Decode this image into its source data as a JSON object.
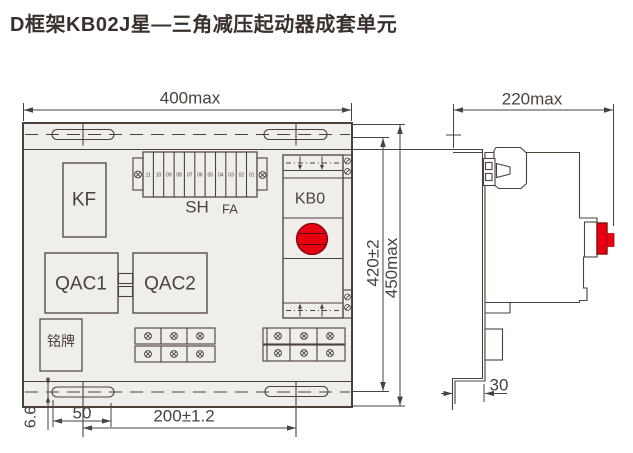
{
  "title": "D框架KB02J星—三角减压起动器成套单元",
  "colors": {
    "accent_red": "#e60012",
    "line": "#4a423c",
    "panel_fill": "#f0eeeb"
  },
  "front_view": {
    "dimensions": {
      "width": "400max",
      "height_outer": "450max",
      "height_holes": "420±2",
      "slot_width": "6.6",
      "slot_length": "50",
      "hole_spacing": "200±1.2"
    },
    "components": {
      "kf": "KF",
      "sh": "SH",
      "fa": "FA",
      "kb0": "KB0",
      "qac1": "QAC1",
      "qac2": "QAC2",
      "nameplate": "铭牌"
    },
    "terminal_numbers": [
      "11",
      "10",
      "09",
      "08",
      "07",
      "06",
      "05",
      "04",
      "03",
      "02",
      "01"
    ]
  },
  "side_view": {
    "dimensions": {
      "depth": "220max",
      "foot_offset": "30"
    }
  },
  "icons": {
    "screw": "screw-cross-terminal",
    "slot": "mounting-slot",
    "button": "red-push-button"
  }
}
